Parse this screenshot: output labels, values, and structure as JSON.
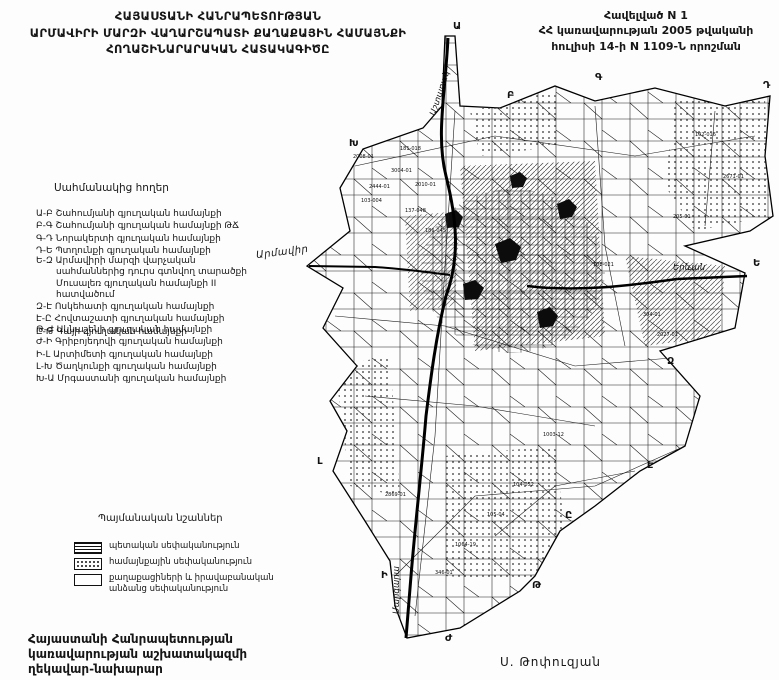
{
  "page": {
    "title_lines": [
      "ՀԱՅԱՍՏԱՆԻ ՀԱՆՐԱՊԵՏՈՒԹՅԱՆ",
      "ԱՐՄԱՎԻՐԻ ՄԱՐԶԻ ՎԱՂԱՐՇԱՊԱՏԻ ՔԱՂԱՔԱՅԻՆ ՀԱՄԱՅՆՔԻ",
      "ՀՈՂԱՇԻՆԱՐԱՐԱԿԱՆ ՀԱՏԱԿԱԳԻԾԸ"
    ],
    "annex_lines": [
      "Հավելված N 1",
      "ՀՀ կառավարության 2005 թվականի",
      "հուլիսի 14-ի N 1109-Ն որոշման"
    ],
    "footer_left_lines": [
      "Հայաստանի Հանրապետության",
      "կառավարության աշխատակազմի",
      "ղեկավար-նախարար"
    ],
    "signature": "Ս. Թոփուզյան"
  },
  "border_lands": {
    "heading": "Սահմանակից հողեր",
    "group1": [
      "Ա-Բ Շահումյանի գյուղական համայնքի",
      "Բ-Գ Շահումյանի գյուղական համայնքի ԹՃ",
      "Գ-Դ Նորակերտի գյուղական համայնքի",
      "Դ-Ե Պտղունքի գյուղական համայնքի"
    ],
    "group2": [
      "Ե-Զ Արմավիրի մարզի վարչական սահմաններից դուրս գտնվող տարածքի Մուսալեռ գյուղական համայնքի II հատվածում",
      "Զ-Է Ոսկեհատի գյուղական համայնքի",
      "Է-Ը Հովտաշատի գյուղական համայնքի",
      "Ը-Թ Գայի գյուղական համայնքի"
    ],
    "group3": [
      "Թ-Ժ Ակնաշենի գյուղական համայնքի",
      "Ժ-Ի Գրիբոյեդովի գյուղական համայնքի",
      "Ի-Լ Արտիմետի գյուղական համայնքի",
      "Լ-Խ Ծաղկունքի գյուղական համայնքի",
      "Խ-Ա Մրգաստանի գյուղական համայնքի"
    ]
  },
  "legend": {
    "heading": "Պայմանական նշաններ",
    "items": [
      "պետական սեփականություն",
      "համայնքային սեփականություն",
      "քաղաքացիների և իրավաբանական անձանց սեփականություն"
    ]
  },
  "map": {
    "road_labels": {
      "armavir": "Արմավիր",
      "yerevan": "Երևան",
      "ashtarak": "Աշտարակ",
      "margara": "Մարգարա"
    },
    "boundary_letters": [
      "Ա",
      "Բ",
      "Գ",
      "Դ",
      "Ե",
      "Զ",
      "Է",
      "Ը",
      "Թ",
      "Ժ",
      "Ի",
      "Լ",
      "Խ"
    ],
    "parcel_codes": [
      "2008-01",
      "181-018",
      "3004-01",
      "2444-01",
      "103-004",
      "2010-01",
      "137-048",
      "186-045",
      "102-016",
      "2671-01",
      "205-01",
      "304-01",
      "2027-01",
      "1003-12",
      "104-052",
      "105-04",
      "1064-19",
      "346-01",
      "2869-01",
      "108-021"
    ]
  }
}
